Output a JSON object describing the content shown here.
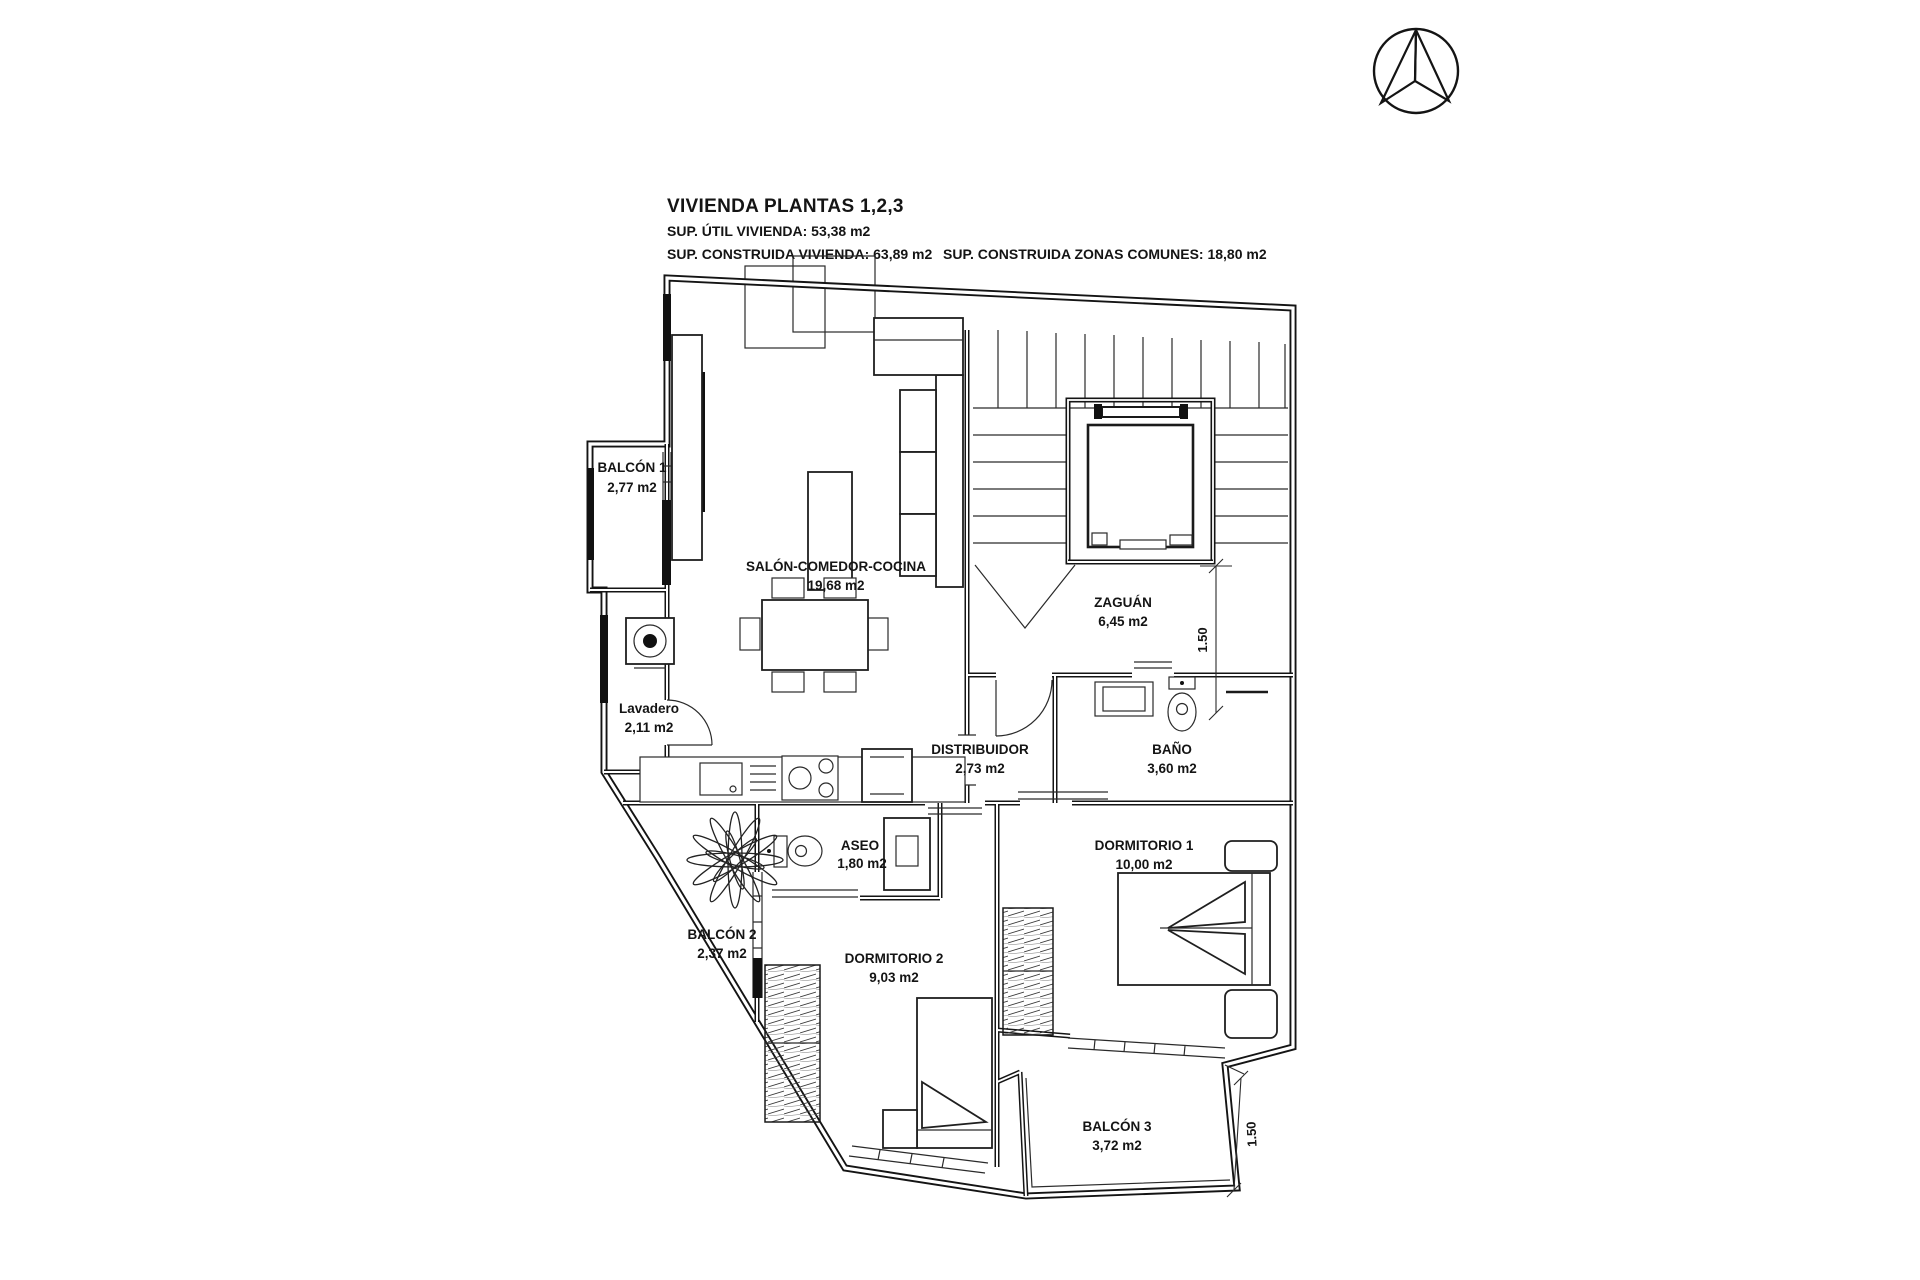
{
  "header": {
    "title": "VIVIENDA PLANTAS 1,2,3",
    "line_util": "SUP. ÚTIL VIVIENDA: 53,38 m2",
    "line_construida": "SUP. CONSTRUIDA VIVIENDA: 63,89 m2",
    "line_comunes": "SUP. CONSTRUIDA ZONAS COMUNES: 18,80 m2"
  },
  "compass": {
    "name": "north-arrow"
  },
  "rooms": {
    "balcon1": {
      "name": "BALCÓN 1",
      "area": "2,77 m2"
    },
    "salon": {
      "name": "SALÓN-COMEDOR-COCINA",
      "area": "19,68 m2"
    },
    "zaguan": {
      "name": "ZAGUÁN",
      "area": "6,45 m2"
    },
    "lavadero": {
      "name": "Lavadero",
      "area": "2,11 m2"
    },
    "distribuidor": {
      "name": "DISTRIBUIDOR",
      "area": "2,73 m2"
    },
    "bano": {
      "name": "BAÑO",
      "area": "3,60 m2"
    },
    "aseo": {
      "name": "ASEO",
      "area": "1,80 m2"
    },
    "dormitorio1": {
      "name": "DORMITORIO 1",
      "area": "10,00 m2"
    },
    "balcon2": {
      "name": "BALCÓN 2",
      "area": "2,37 m2"
    },
    "dormitorio2": {
      "name": "DORMITORIO 2",
      "area": "9,03 m2"
    },
    "balcon3": {
      "name": "BALCÓN 3",
      "area": "3,72 m2"
    }
  },
  "dimensions": {
    "right_upper": "1.50",
    "right_lower": "1.50"
  },
  "line_color": "#141414",
  "background_color": "#ffffff"
}
